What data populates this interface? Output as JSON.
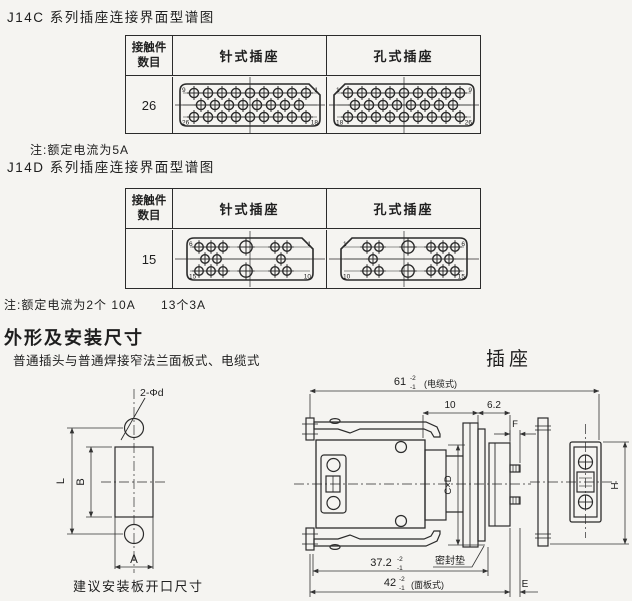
{
  "page": {
    "bg": "#f5f4f1",
    "ink": "#1e1e1e"
  },
  "j14c": {
    "title": "J14C 系列插座连接界面型谱图",
    "note": "注:额定电流为5A",
    "count": "26"
  },
  "j14d": {
    "title": "J14D 系列插座连接界面型谱图",
    "note": "注:额定电流为2个 10A      13个3A",
    "count": "15"
  },
  "table_headers": {
    "contacts1": "接触件",
    "contacts2": "数目",
    "pin": "针式插座",
    "socket": "孔式插座"
  },
  "outline": {
    "heading": "外形及安装尺寸",
    "subheading": "普通插头与普通焊接窄法兰面板式、电缆式",
    "socket_label": "插座",
    "plate_caption": "建议安装板开口尺寸"
  },
  "plate_dims": {
    "holes": "2-Φd",
    "L": "L",
    "B": "B",
    "A": "A"
  },
  "socket_dims": {
    "d61": "61",
    "d61_sup": "-2",
    "d61_sub": "-1",
    "d61_suffix": "(电缆式)",
    "d10": "10",
    "d62": "6.2",
    "F": "F",
    "CxD": "C×D",
    "H": "H",
    "d372": "37.2",
    "d372_sup": "-2",
    "d372_sub": "-1",
    "seal": "密封垫",
    "d42": "42",
    "d42_sup": "-2",
    "d42_sub": "-1",
    "d42_suffix": "(面板式)",
    "E": "E"
  },
  "figures": {
    "c26_pin": {
      "chamfer": "tr",
      "contact_r": 4.6,
      "box": {
        "x": 5,
        "y": 7,
        "w": 140,
        "h": 42
      },
      "rows": [
        {
          "y": 16,
          "pts": [
            19,
            33,
            47,
            61,
            75,
            89,
            103,
            117,
            131
          ]
        },
        {
          "y": 28,
          "pts": [
            26,
            40,
            54,
            68,
            82,
            96,
            110,
            124
          ]
        },
        {
          "y": 40,
          "pts": [
            19,
            33,
            47,
            61,
            75,
            89,
            103,
            117,
            131
          ]
        }
      ],
      "corners": {
        "tl": "9",
        "tr": "1",
        "bl": "26",
        "br": "18"
      }
    },
    "c26_hole": {
      "chamfer": "tl",
      "contact_r": 4.6,
      "box": {
        "x": 5,
        "y": 7,
        "w": 140,
        "h": 42
      },
      "rows": [
        {
          "y": 16,
          "pts": [
            19,
            33,
            47,
            61,
            75,
            89,
            103,
            117,
            131
          ]
        },
        {
          "y": 28,
          "pts": [
            26,
            40,
            54,
            68,
            82,
            96,
            110,
            124
          ]
        },
        {
          "y": 40,
          "pts": [
            19,
            33,
            47,
            61,
            75,
            89,
            103,
            117,
            131
          ]
        }
      ],
      "corners": {
        "tl": "1",
        "tr": "9",
        "bl": "18",
        "br": "26"
      }
    },
    "c15_pin": {
      "chamfer": "tr",
      "contact_r": 4.3,
      "box": {
        "x": 12,
        "y": 7,
        "w": 126,
        "h": 42
      },
      "rows": [
        {
          "y": 16,
          "pts": [
            24,
            36,
            48,
            {
              "x": 71,
              "r": 6.2
            },
            100,
            112
          ]
        },
        {
          "y": 28,
          "pts": [
            30,
            42,
            106
          ]
        },
        {
          "y": 40,
          "pts": [
            24,
            36,
            48,
            {
              "x": 71,
              "r": 6.2
            },
            100,
            112
          ]
        }
      ],
      "corners": {
        "tl": "6",
        "tr": "1",
        "bl": "15",
        "br": "10"
      }
    },
    "c15_hole": {
      "chamfer": "tl",
      "contact_r": 4.3,
      "box": {
        "x": 12,
        "y": 7,
        "w": 126,
        "h": 42
      },
      "rows": [
        {
          "y": 16,
          "pts": [
            38,
            50,
            {
              "x": 79,
              "r": 6.2
            },
            102,
            114,
            126
          ]
        },
        {
          "y": 28,
          "pts": [
            44,
            108,
            120
          ]
        },
        {
          "y": 40,
          "pts": [
            38,
            50,
            {
              "x": 79,
              "r": 6.2
            },
            102,
            114,
            126
          ]
        }
      ],
      "corners": {
        "tl": "1",
        "tr": "6",
        "bl": "10",
        "br": "15"
      }
    }
  }
}
